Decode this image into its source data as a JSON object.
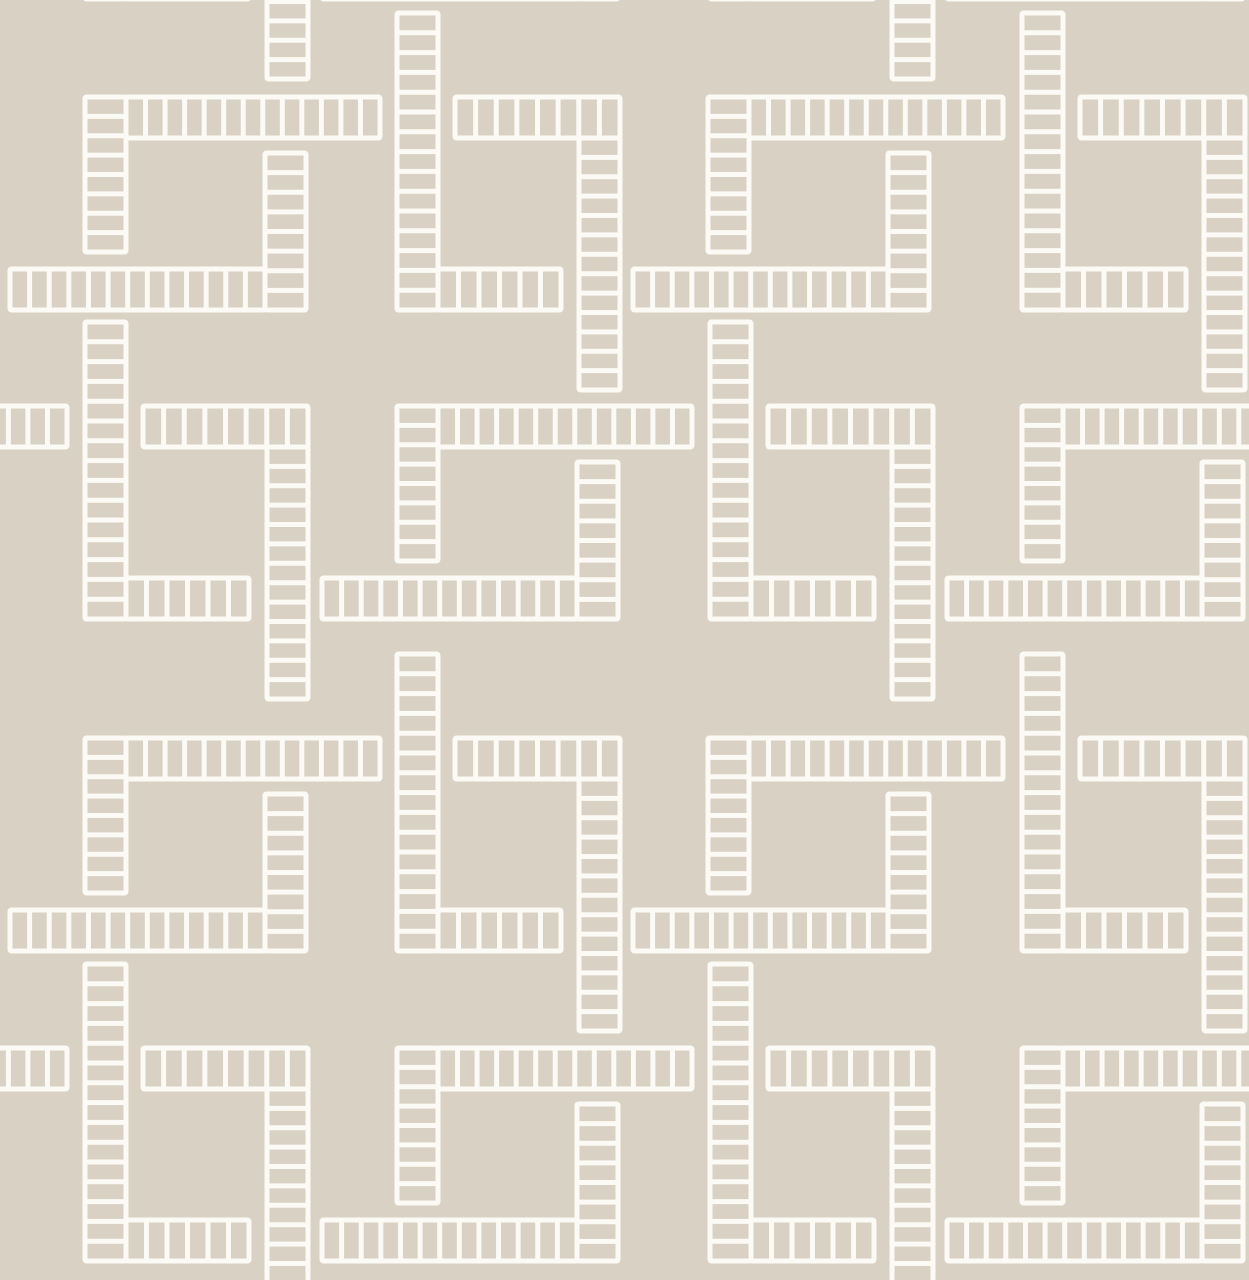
{
  "canvas": {
    "width": 1249,
    "height": 1280
  },
  "palette": {
    "background": "#d8d1c4",
    "line": "#fbfaf5"
  },
  "pattern": {
    "name": "interlocking-brick-squares-wallpaper",
    "strip_thickness": 41,
    "cell_pitch": 20,
    "line_width": 5,
    "pieces": {
      "square": {
        "strips": [
          {
            "name": "top-strip",
            "o": "h",
            "x": 41,
            "y": 0,
            "len": 254
          },
          {
            "name": "left-vertical",
            "o": "v",
            "x": 0,
            "y": 0,
            "len": 155
          },
          {
            "name": "middle-vertical",
            "o": "v",
            "x": 180,
            "y": 56,
            "len": 157
          },
          {
            "name": "bottom-strip",
            "o": "h",
            "x": -75,
            "y": 172,
            "len": 255
          }
        ]
      },
      "l_piece": {
        "strips": [
          {
            "name": "long-vertical",
            "o": "v",
            "x": 0,
            "y": -84,
            "len": 297
          },
          {
            "name": "bottom-arm",
            "o": "h",
            "x": 41,
            "y": 172,
            "len": 123
          }
        ]
      },
      "arm_hang": {
        "strips": [
          {
            "name": "arm",
            "o": "h",
            "x": 0,
            "y": 0,
            "len": 165
          },
          {
            "name": "hanging-vertical",
            "o": "v",
            "x": 124,
            "y": 41,
            "len": 252
          }
        ]
      }
    },
    "rows": [
      {
        "y": -214,
        "squares": [
          -228,
          397,
          1022
        ],
        "l_pieces": [
          85,
          710
        ],
        "arm_hangs": [
          143,
          768
        ]
      },
      {
        "y": 97,
        "squares": [
          85,
          708
        ],
        "l_pieces": [
          397,
          1022
        ],
        "arm_hangs": [
          455,
          1080
        ]
      },
      {
        "y": 406,
        "squares": [
          -228,
          397,
          1022
        ],
        "l_pieces": [
          85,
          710
        ],
        "arm_hangs": [
          143,
          768
        ]
      },
      {
        "y": 738,
        "squares": [
          85,
          708
        ],
        "l_pieces": [
          397,
          1022
        ],
        "arm_hangs": [
          455,
          1080
        ]
      },
      {
        "y": 1048,
        "squares": [
          -228,
          397,
          1022
        ],
        "l_pieces": [
          85,
          710
        ],
        "arm_hangs": [
          143,
          768
        ]
      }
    ]
  }
}
